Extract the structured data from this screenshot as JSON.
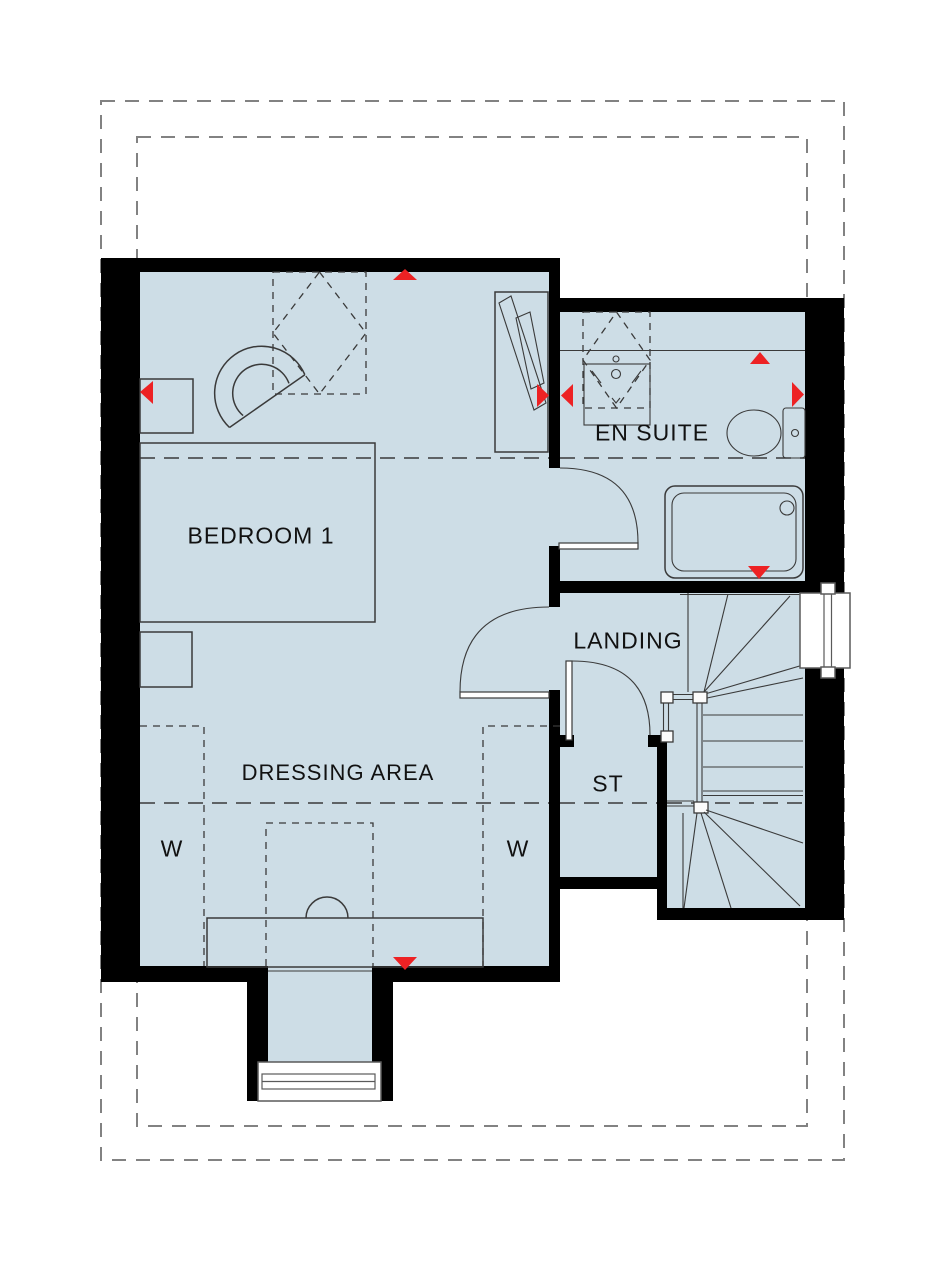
{
  "plan": {
    "title": "First floor plan",
    "rooms": {
      "bedroom": {
        "label": "BEDROOM 1"
      },
      "ensuite": {
        "label": "EN SUITE"
      },
      "landing": {
        "label": "LANDING"
      },
      "storage": {
        "label": "ST"
      },
      "dressing": {
        "label": "DRESSING AREA"
      },
      "wardrobe_left": {
        "label": "W"
      },
      "wardrobe_right": {
        "label": "W"
      }
    },
    "markers": {
      "window_marker_count": 8,
      "marker_shape": "red-triangle"
    }
  },
  "colors": {
    "floor": "#cdDde6",
    "wall": "#000000",
    "line": "#3a3a3a",
    "roof_dash": "#828282",
    "accent_red": "#ed2224",
    "background": "#ffffff"
  }
}
